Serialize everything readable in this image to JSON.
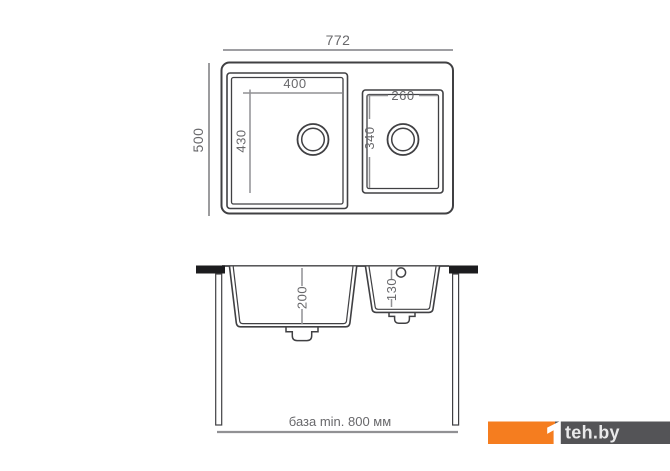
{
  "top_view": {
    "overall_width_mm": "772",
    "overall_depth_mm": "500",
    "main_bowl": {
      "width_mm": "400",
      "depth_mm": "430"
    },
    "second_bowl": {
      "width_mm": "260",
      "depth_mm": "340"
    }
  },
  "section_view": {
    "main_bowl_depth_mm": "200",
    "second_bowl_depth_mm": "130",
    "cabinet_note": "база min. 800 мм"
  },
  "watermark": {
    "logo_mark": "1",
    "logo_text": "teh.by",
    "orange_color": "#f57d1f",
    "gray_color": "#545457"
  },
  "colors": {
    "drawing_line": "#404043",
    "dimension_line": "#919194",
    "dimension_text": "#68686b",
    "countertop": "#1c1c1e",
    "background": "#ffffff"
  }
}
